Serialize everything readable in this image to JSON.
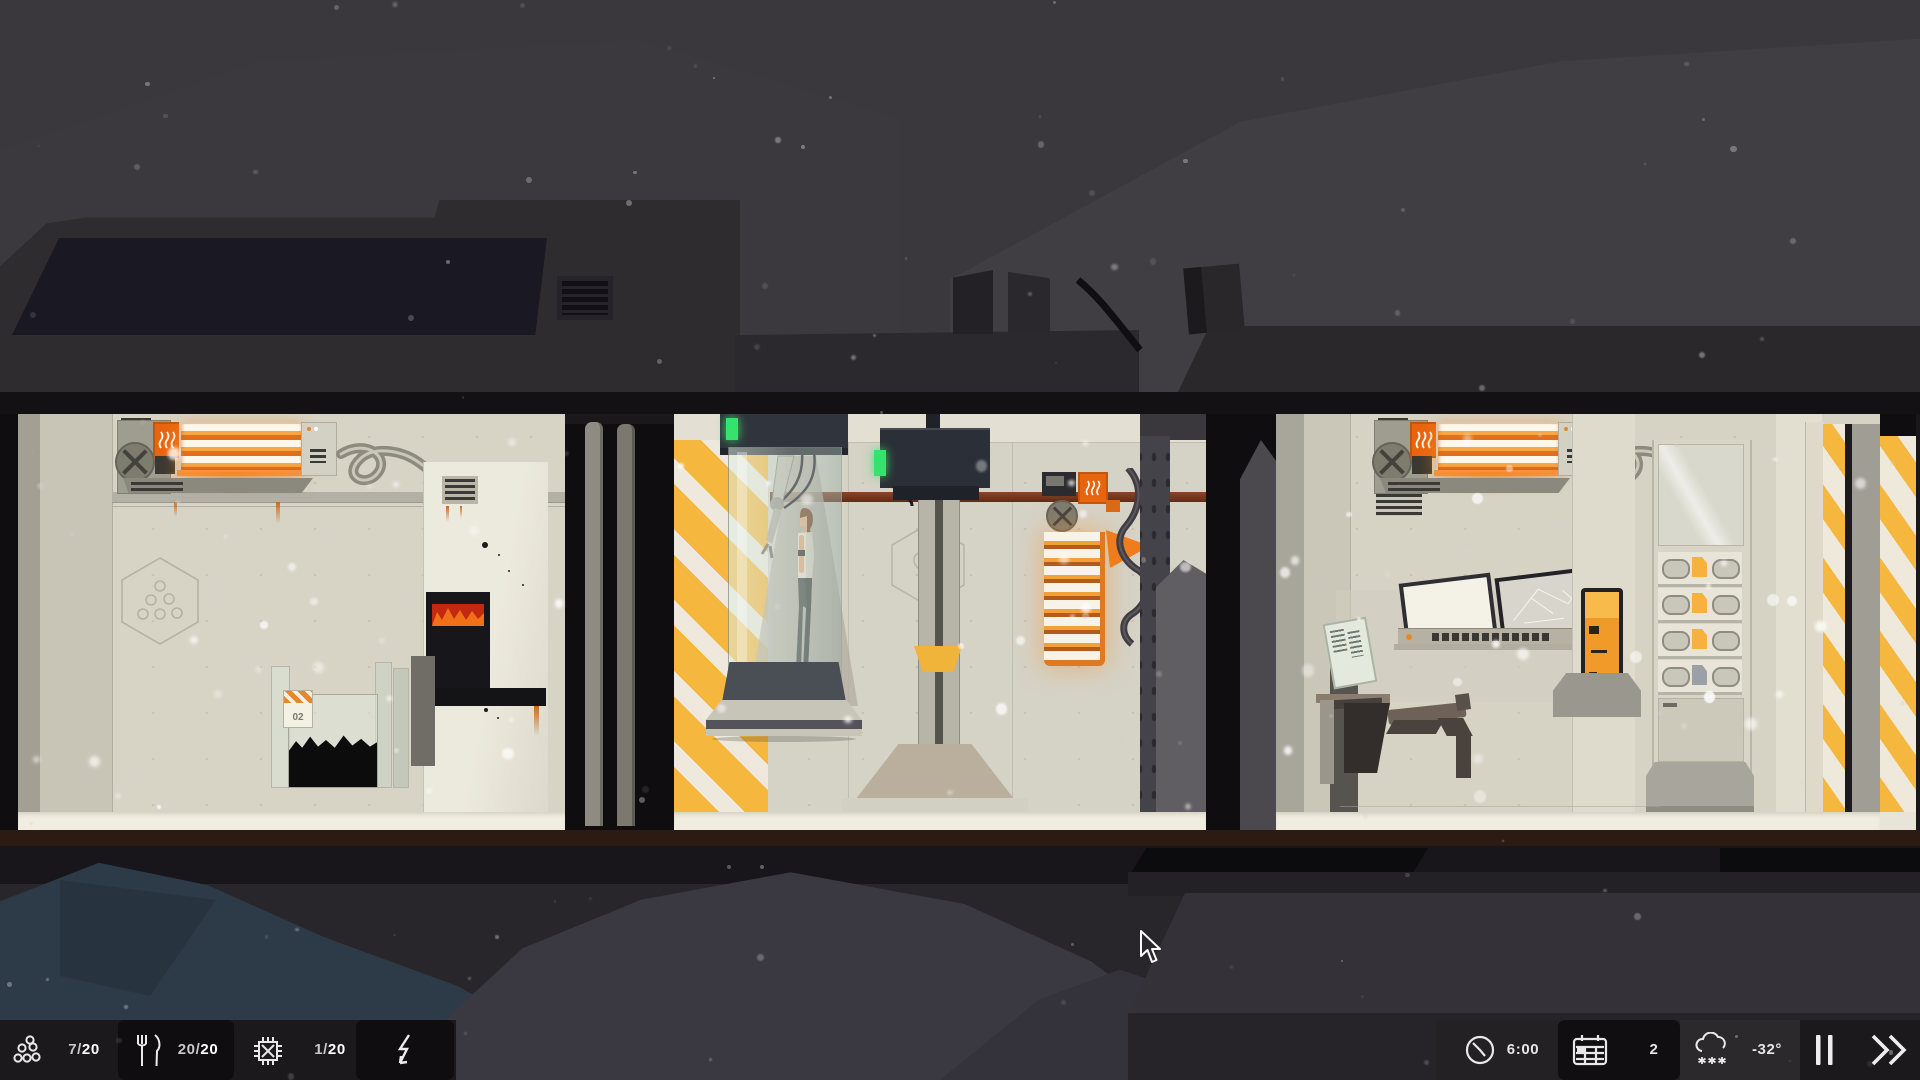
{
  "hud": {
    "survivors": {
      "value": "7/",
      "max": "20",
      "icon": "population-icon"
    },
    "food": {
      "value": "20/",
      "max": "20",
      "icon": "food-icon"
    },
    "components": {
      "value": "1/",
      "max": "20",
      "icon": "components-chip-icon"
    },
    "energy": {
      "icon": "energy-bolt-icon"
    },
    "time": {
      "value": "6:00",
      "icon": "clock-icon"
    },
    "day": {
      "value": "2",
      "icon": "calendar-icon"
    },
    "weather": {
      "value": "-32°",
      "icon": "snow-cloud-icon"
    },
    "controls": {
      "pause_icon": "pause-icon",
      "fast_forward_icon": "fast-forward-icon"
    }
  },
  "scene": {
    "room1_bin_label": "02",
    "room3_wall_number": "04"
  },
  "colors": {
    "sky": "#3a383c",
    "mtn": "#403e43",
    "roof": "#2e2c2f",
    "roof2": "#2a282b",
    "window": "#1a1822",
    "hull": "#131114",
    "wall": "#d7d4c6",
    "walllight": "#e2dfd2",
    "floor": "#f1eee1",
    "hazard": "#f5b73d",
    "stripe": "#eee9dc",
    "accent": "#e8650f",
    "glow": "#f59a3e",
    "green": "#35e26b",
    "pipe": "#7e3f20",
    "ground": "#28262a",
    "bluemound": "#2d3b48",
    "graymound": "#3a3840",
    "panel": "#343238",
    "hudbar": "#1c191c",
    "hudbox": "#0f0d0f",
    "hudbar2": "#242124",
    "hudlight": "#2b292c",
    "hudctrl": "#1b191b",
    "txtdim": "#c9c6ca",
    "txt": "#ffffff"
  },
  "snow": {
    "seed": 12,
    "ambient_count": 130,
    "room_count": 70
  }
}
